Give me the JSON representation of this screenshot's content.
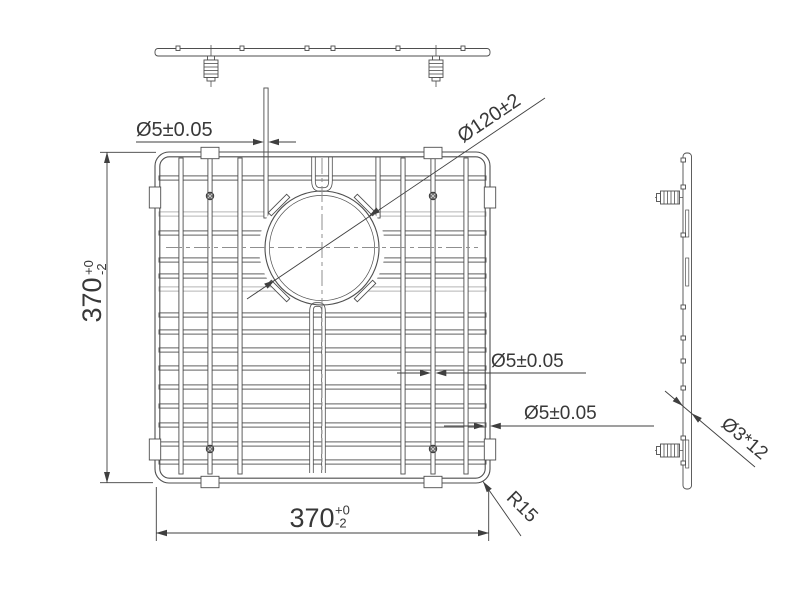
{
  "drawing": {
    "colors": {
      "background": "#ffffff",
      "line": "#4e4e4e",
      "light_line": "#ababab",
      "dimension_line": "#3f3f3f",
      "text": "#383838"
    },
    "labels": {
      "wire_dia_top": "Ø5±0.05",
      "hole_dia": "Ø120±2",
      "wire_dia_mid": "Ø5±0.05",
      "rim_dia": "Ø5±0.05",
      "corner_radius": "R15",
      "foot_screw": "Ø3*12",
      "height": {
        "value": "370",
        "tol_plus": "+0",
        "tol_minus": "-2"
      },
      "width": {
        "value": "370",
        "tol_plus": "+0",
        "tol_minus": "-2"
      }
    }
  }
}
